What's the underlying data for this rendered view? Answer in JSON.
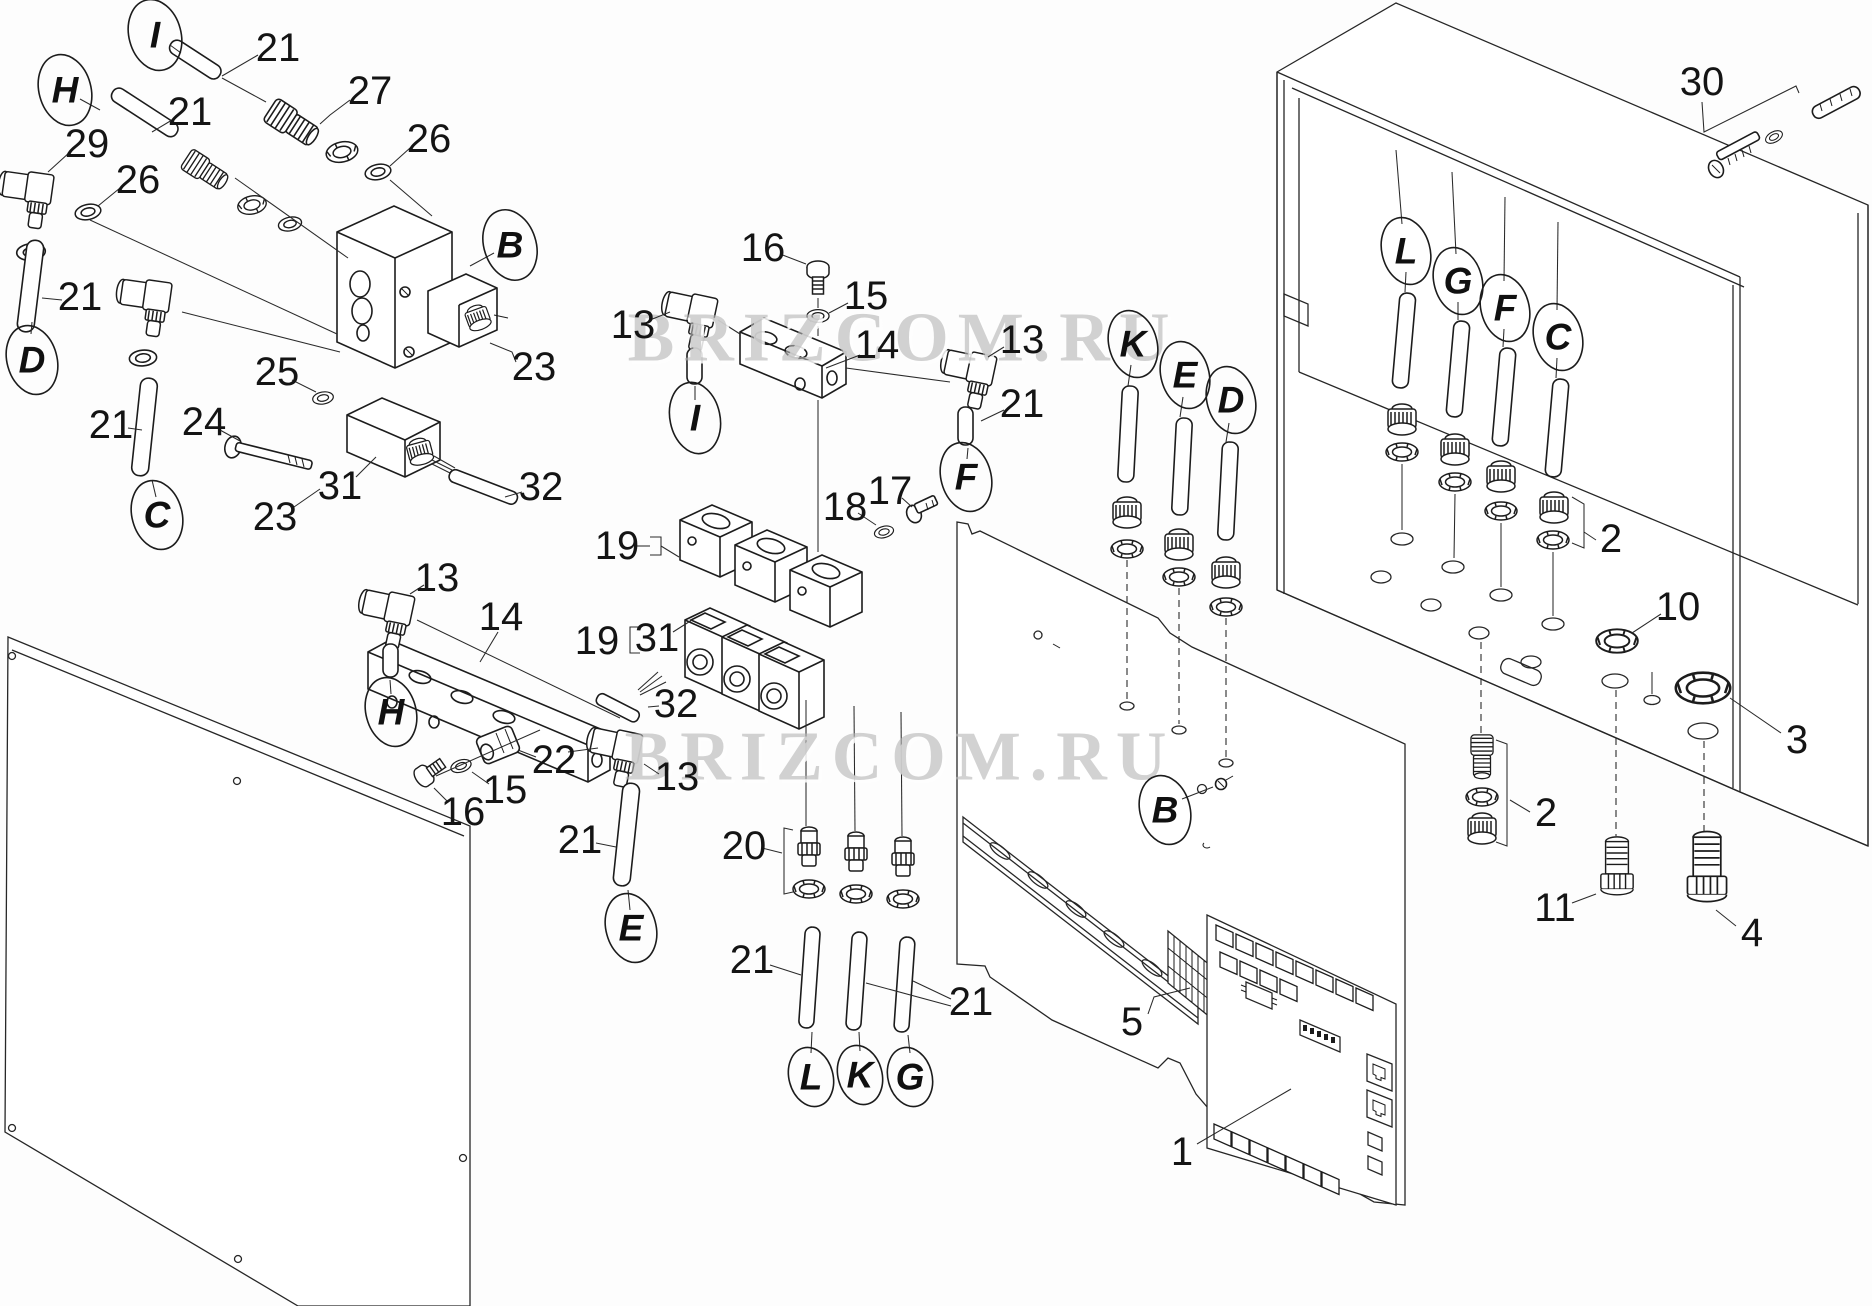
{
  "figure": {
    "kind": "exploded-parts-diagram",
    "line_color": "#1c1c1c",
    "background": "#fdfdfd"
  },
  "watermark": {
    "text": "BRIZCOM.RU",
    "color": "#b7b7b7"
  },
  "callouts": [
    {
      "text": "21"
    },
    {
      "text": "27"
    },
    {
      "text": "26"
    },
    {
      "text": "21"
    },
    {
      "text": "29"
    },
    {
      "text": "26"
    },
    {
      "text": "21"
    },
    {
      "text": "21"
    },
    {
      "text": "25"
    },
    {
      "text": "24"
    },
    {
      "text": "23"
    },
    {
      "text": "31"
    },
    {
      "text": "32"
    },
    {
      "text": "23"
    },
    {
      "text": "16"
    },
    {
      "text": "15"
    },
    {
      "text": "13"
    },
    {
      "text": "14"
    },
    {
      "text": "13"
    },
    {
      "text": "21"
    },
    {
      "text": "18"
    },
    {
      "text": "17"
    },
    {
      "text": "19"
    },
    {
      "text": "19"
    },
    {
      "text": "31"
    },
    {
      "text": "13"
    },
    {
      "text": "14"
    },
    {
      "text": "22"
    },
    {
      "text": "15"
    },
    {
      "text": "16"
    },
    {
      "text": "13"
    },
    {
      "text": "21"
    },
    {
      "text": "20"
    },
    {
      "text": "21"
    },
    {
      "text": "21"
    },
    {
      "text": "32"
    },
    {
      "text": "5"
    },
    {
      "text": "1"
    },
    {
      "text": "30"
    },
    {
      "text": "2"
    },
    {
      "text": "10"
    },
    {
      "text": "3"
    },
    {
      "text": "2"
    },
    {
      "text": "11"
    },
    {
      "text": "4"
    }
  ],
  "letter_tags": [
    {
      "text": "I"
    },
    {
      "text": "H"
    },
    {
      "text": "D"
    },
    {
      "text": "C"
    },
    {
      "text": "B"
    },
    {
      "text": "I"
    },
    {
      "text": "F"
    },
    {
      "text": "H"
    },
    {
      "text": "E"
    },
    {
      "text": "L"
    },
    {
      "text": "K"
    },
    {
      "text": "G"
    },
    {
      "text": "K"
    },
    {
      "text": "E"
    },
    {
      "text": "D"
    },
    {
      "text": "B"
    },
    {
      "text": "L"
    },
    {
      "text": "G"
    },
    {
      "text": "F"
    },
    {
      "text": "C"
    }
  ]
}
